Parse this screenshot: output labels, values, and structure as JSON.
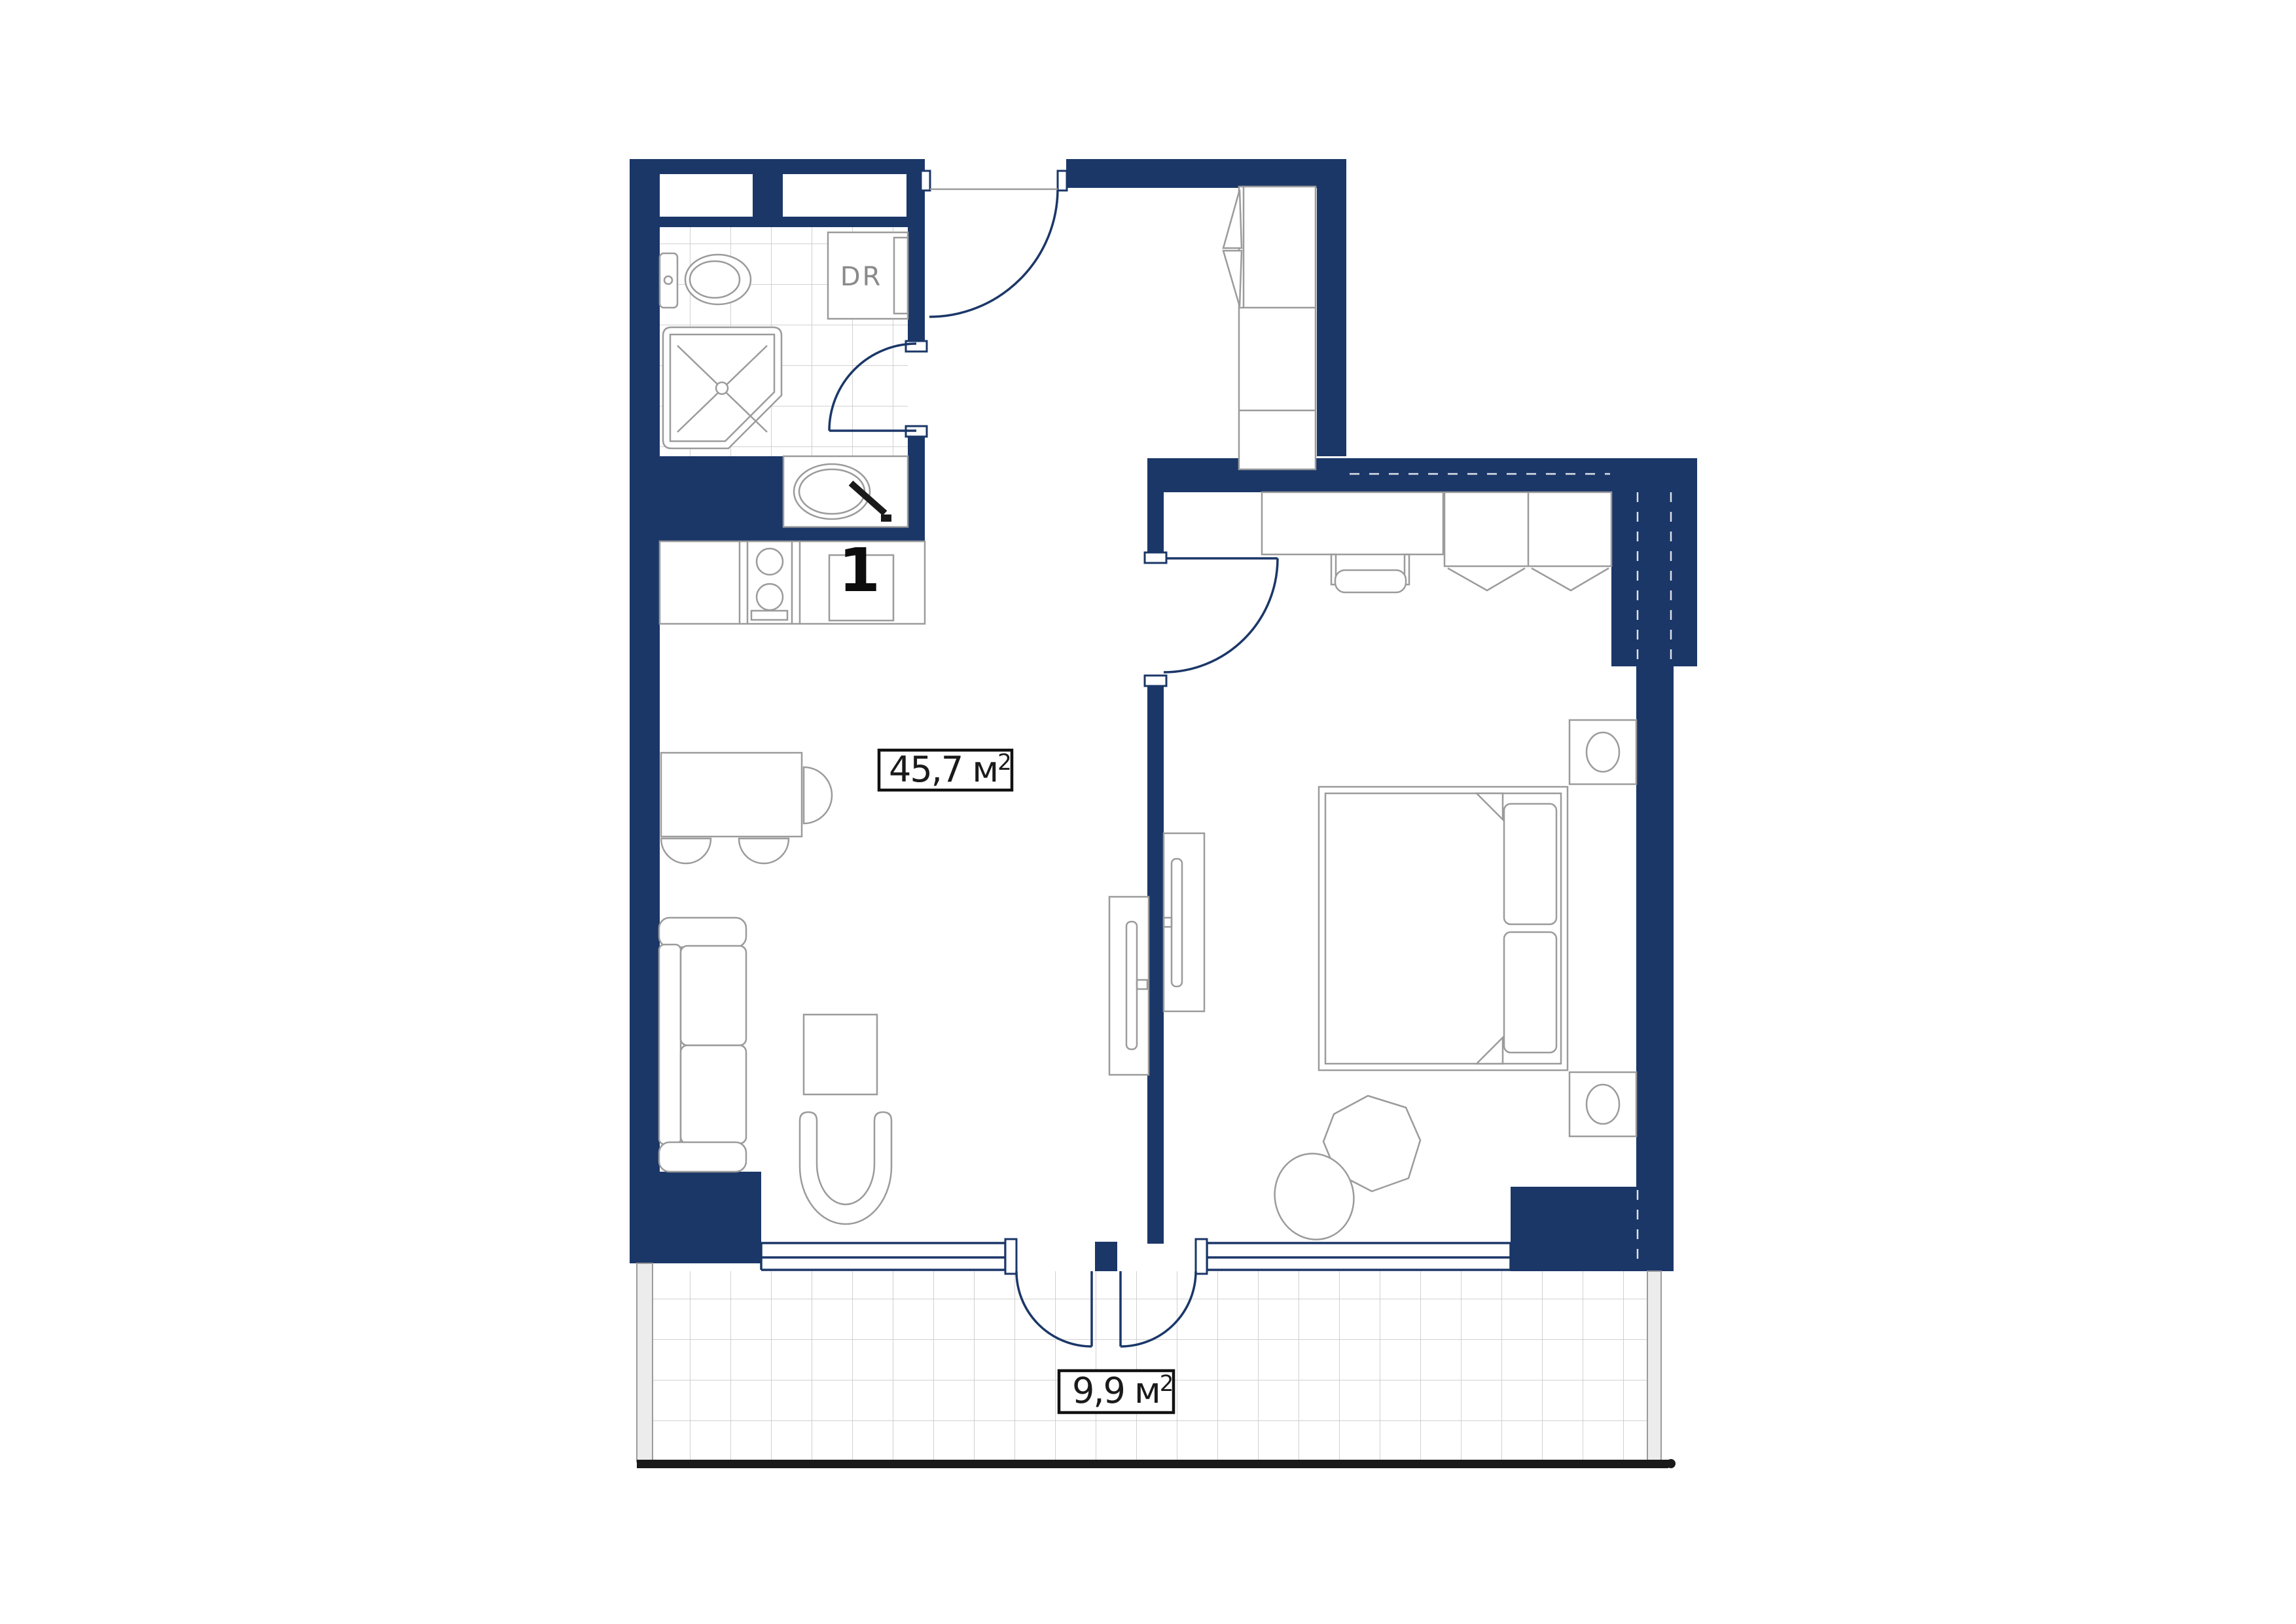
{
  "floor_plan": {
    "room_number": "1",
    "closet_label": "DR",
    "areas": {
      "main": {
        "value": "45,7",
        "unit": " м",
        "sup": "2"
      },
      "balcony": {
        "value": "9,9",
        "unit": " м",
        "sup": "2"
      }
    },
    "colors": {
      "wall_fill": "#1b3768",
      "plan_line": "#1b3768",
      "furniture_line": "#9b9b9b",
      "tile_line": "#cccccc",
      "label_text": "#1a1a1a",
      "railing": "#1a1a1a",
      "background": "#ffffff"
    }
  }
}
